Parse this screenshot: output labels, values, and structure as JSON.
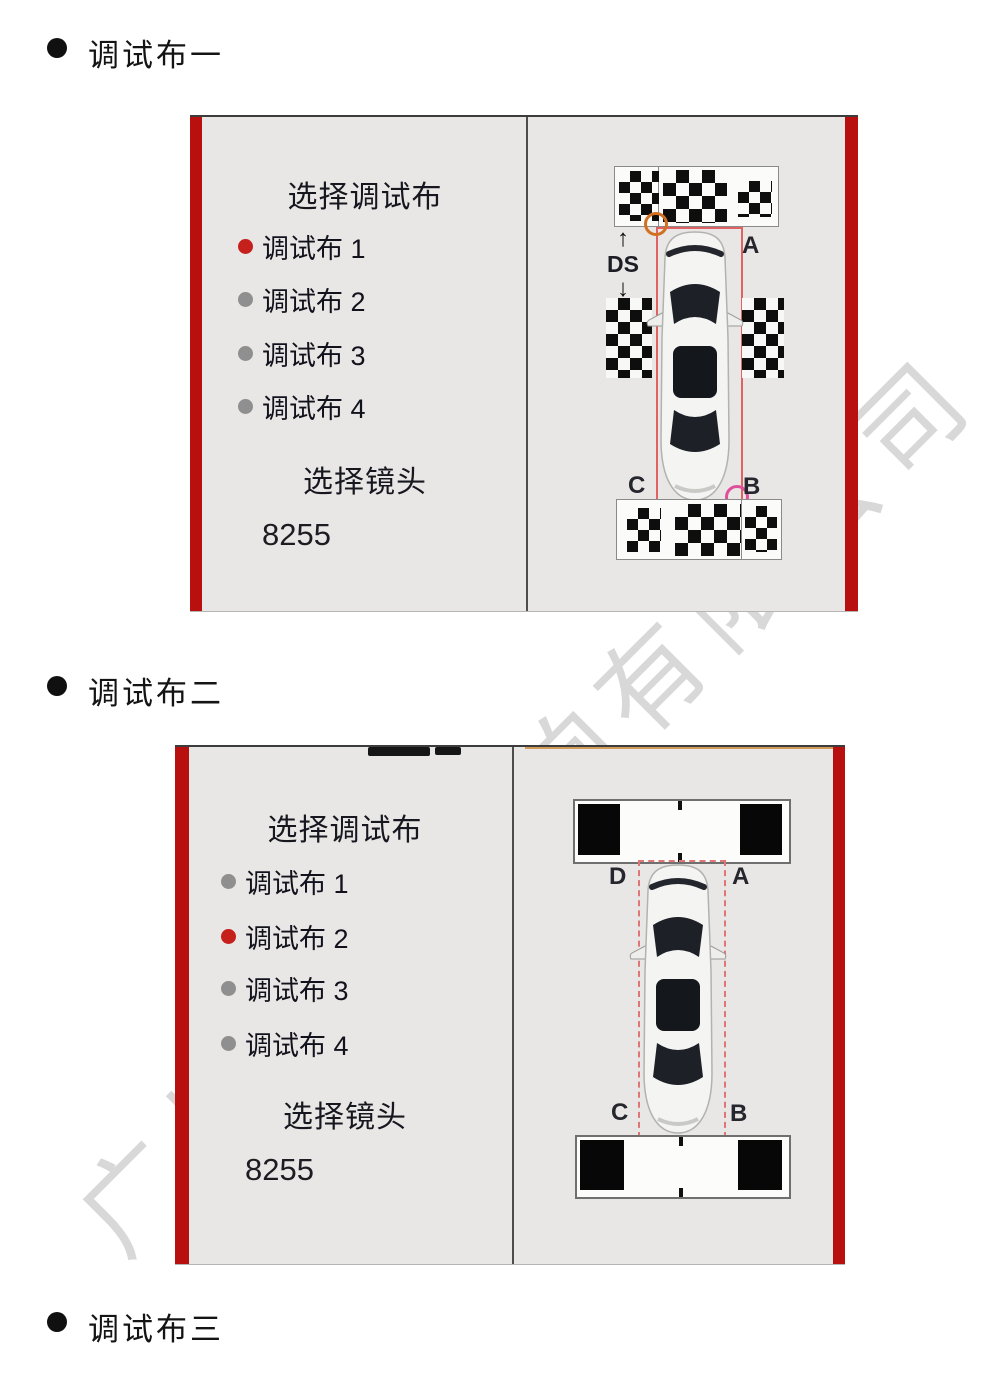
{
  "page": {
    "bullets": [
      {
        "label": "调试布一"
      },
      {
        "label": "调试布二"
      },
      {
        "label": "调试布三"
      }
    ],
    "watermark_text": "广州汽车音响有限公司"
  },
  "cloth1_screen": {
    "select_cloth_title": "选择调试布",
    "cloth_options": [
      {
        "label": "调试布 1",
        "selected": true
      },
      {
        "label": "调试布 2",
        "selected": false
      },
      {
        "label": "调试布 3",
        "selected": false
      },
      {
        "label": "调试布 4",
        "selected": false
      }
    ],
    "select_lens_title": "选择镜头",
    "lens_value": "8255",
    "diagram": {
      "corner_label_a": "A",
      "corner_label_b": "B",
      "corner_label_c": "C",
      "distance_label": "DS",
      "arrow_up": "↑",
      "arrow_down": "↓"
    },
    "colors": {
      "side_red_bar": "#b80f0f",
      "selected_dot": "#c5201c",
      "unselected_dot": "#8f8f8f",
      "calibration_box": "#e06262",
      "top_corner_marker": "#d2701f",
      "bottom_corner_marker": "#e0509a"
    }
  },
  "cloth2_screen": {
    "select_cloth_title": "选择调试布",
    "cloth_options": [
      {
        "label": "调试布 1",
        "selected": false
      },
      {
        "label": "调试布 2",
        "selected": true
      },
      {
        "label": "调试布 3",
        "selected": false
      },
      {
        "label": "调试布 4",
        "selected": false
      }
    ],
    "select_lens_title": "选择镜头",
    "lens_value": "8255",
    "diagram": {
      "corner_label_a": "A",
      "corner_label_b": "B",
      "corner_label_c": "C",
      "corner_label_d": "D"
    }
  }
}
